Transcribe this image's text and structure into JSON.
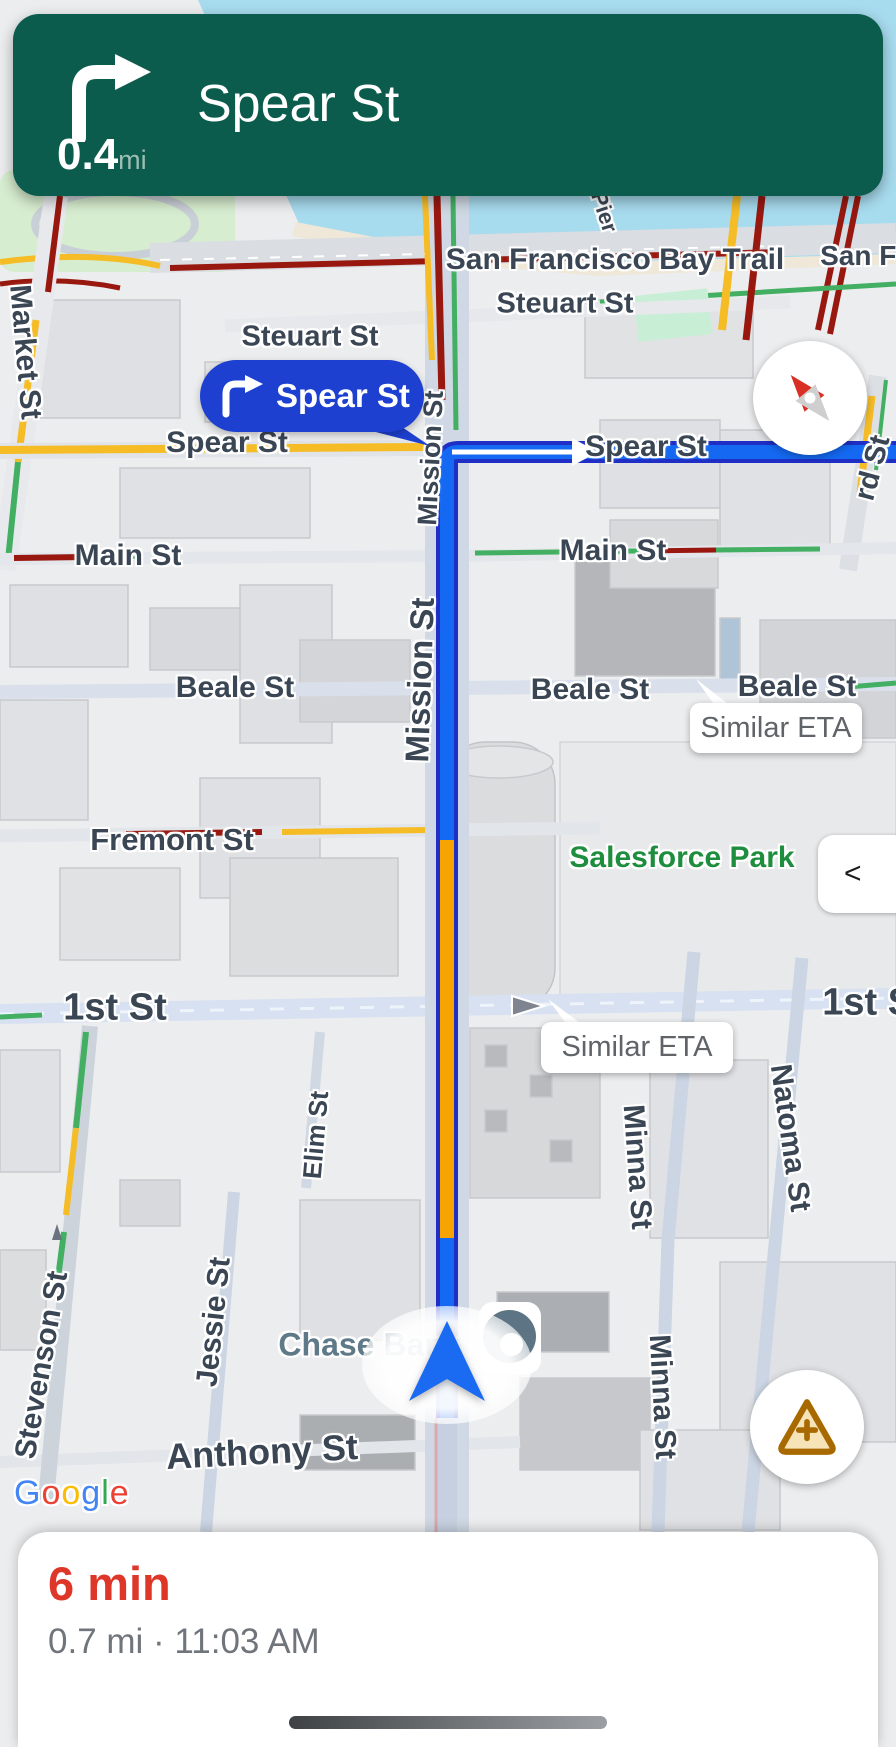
{
  "banner": {
    "instruction": "Spear St",
    "distance": "0.4",
    "distance_unit": "mi"
  },
  "callout": {
    "label": "Spear St"
  },
  "eta_bubbles": [
    "Similar ETA",
    "Similar ETA"
  ],
  "collapse_button": {
    "label": "<"
  },
  "bottom_sheet": {
    "eta": "6 min",
    "details": "0.7 mi · 11:03 AM"
  },
  "map": {
    "attribution_letters": [
      {
        "ch": "G",
        "color": "#4285F4"
      },
      {
        "ch": "o",
        "color": "#EA4335"
      },
      {
        "ch": "o",
        "color": "#FBBC05"
      },
      {
        "ch": "g",
        "color": "#4285F4"
      },
      {
        "ch": "l",
        "color": "#34A853"
      },
      {
        "ch": "e",
        "color": "#EA4335"
      }
    ],
    "labels": [
      {
        "t": "San Francisco Bay Trail",
        "x": 615,
        "y": 260,
        "fs": 30
      },
      {
        "t": "San Fran",
        "x": 880,
        "y": 256,
        "fs": 28
      },
      {
        "t": "Pier",
        "x": 604,
        "y": 212,
        "fs": 22,
        "rot": 72
      },
      {
        "t": "Steuart St",
        "x": 310,
        "y": 337,
        "fs": 29
      },
      {
        "t": "Steuart St",
        "x": 565,
        "y": 304,
        "fs": 29
      },
      {
        "t": "Spear St",
        "x": 227,
        "y": 443,
        "fs": 30
      },
      {
        "t": "Spear St",
        "x": 646,
        "y": 447,
        "fs": 30
      },
      {
        "t": "Main St",
        "x": 128,
        "y": 556,
        "fs": 30
      },
      {
        "t": "Main St",
        "x": 613,
        "y": 551,
        "fs": 30
      },
      {
        "t": "Beale St",
        "x": 235,
        "y": 688,
        "fs": 30
      },
      {
        "t": "Beale St",
        "x": 590,
        "y": 690,
        "fs": 30
      },
      {
        "t": "Beale St",
        "x": 797,
        "y": 687,
        "fs": 30
      },
      {
        "t": "Fremont St",
        "x": 172,
        "y": 840,
        "fs": 31
      },
      {
        "t": "Salesforce Park",
        "x": 682,
        "y": 858,
        "fs": 30,
        "cls": "green"
      },
      {
        "t": "1st St",
        "x": 115,
        "y": 1008,
        "fs": 38
      },
      {
        "t": "1st St",
        "x": 874,
        "y": 1003,
        "fs": 38
      },
      {
        "t": "Market St",
        "x": 25,
        "y": 352,
        "fs": 30,
        "rot": 85
      },
      {
        "t": "Mission St",
        "x": 431,
        "y": 458,
        "fs": 27,
        "rot": -87
      },
      {
        "t": "Mission St",
        "x": 420,
        "y": 680,
        "fs": 33,
        "rot": -88
      },
      {
        "t": "Natoma St",
        "x": 790,
        "y": 1138,
        "fs": 30,
        "rot": 82
      },
      {
        "t": "Minna St",
        "x": 637,
        "y": 1167,
        "fs": 30,
        "rot": 86
      },
      {
        "t": "Minna St",
        "x": 662,
        "y": 1397,
        "fs": 30,
        "rot": 87
      },
      {
        "t": "Elim St",
        "x": 316,
        "y": 1135,
        "fs": 26,
        "rot": -85
      },
      {
        "t": "Jessie St",
        "x": 214,
        "y": 1322,
        "fs": 30,
        "rot": -84
      },
      {
        "t": "Stevenson St",
        "x": 42,
        "y": 1365,
        "fs": 30,
        "rot": -80
      },
      {
        "t": "Anthony St",
        "x": 262,
        "y": 1452,
        "fs": 36,
        "rot": -3
      },
      {
        "t": "Chase Bank",
        "x": 370,
        "y": 1345,
        "fs": 32,
        "cls": "teal"
      },
      {
        "t": "rd St",
        "x": 873,
        "y": 468,
        "fs": 29,
        "rot": -75
      }
    ]
  },
  "colors": {
    "banner_green": "#0B5C4D",
    "callout_blue": "#1E40D0",
    "route_fill": "#1468F1",
    "route_border": "#1F2FC6",
    "traffic_orange": "#F7A400",
    "traffic_red": "#98180F",
    "traffic_yellow": "#F5BC26",
    "traffic_green": "#43AF62",
    "eta_red": "#DE372A",
    "water": "#A7DBEE",
    "park_green": "#D7EDCF",
    "warning_amber": "#A86A00"
  }
}
